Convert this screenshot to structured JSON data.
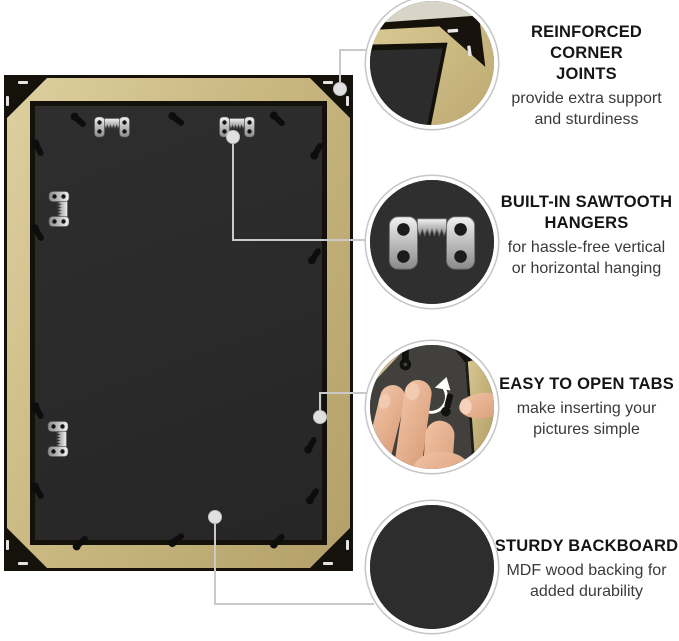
{
  "callouts": [
    {
      "title_lines": [
        "REINFORCED CORNER",
        "JOINTS"
      ],
      "desc_lines": [
        "provide extra support",
        "and sturdiness"
      ]
    },
    {
      "title_lines": [
        "BUILT-IN SAWTOOTH",
        "HANGERS"
      ],
      "desc_lines": [
        "for hassle-free vertical",
        "or horizontal hanging"
      ]
    },
    {
      "title_lines": [
        "EASY TO OPEN TABS"
      ],
      "desc_lines": [
        "make inserting your",
        "pictures simple"
      ]
    },
    {
      "title_lines": [
        "STURDY BACKBOARD"
      ],
      "desc_lines": [
        "MDF wood backing for",
        "added durability"
      ]
    }
  ],
  "icons": {
    "bubble_1": "corner-joint-closeup",
    "bubble_2": "sawtooth-hanger-closeup",
    "bubble_3": "hand-turning-tab-closeup",
    "bubble_4": "backboard-closeup",
    "rotate_arrow": "rotate-clockwise-arrow"
  },
  "colors": {
    "frame_gold": "#c7b37c",
    "backboard": "#2b2b2b",
    "corner_black": "#15110b",
    "connector_gray": "#c9c9c9",
    "heading_text": "#151515",
    "body_text": "#3a3a3a",
    "skin": "#e8b795",
    "metal": "#c9c9c9"
  }
}
